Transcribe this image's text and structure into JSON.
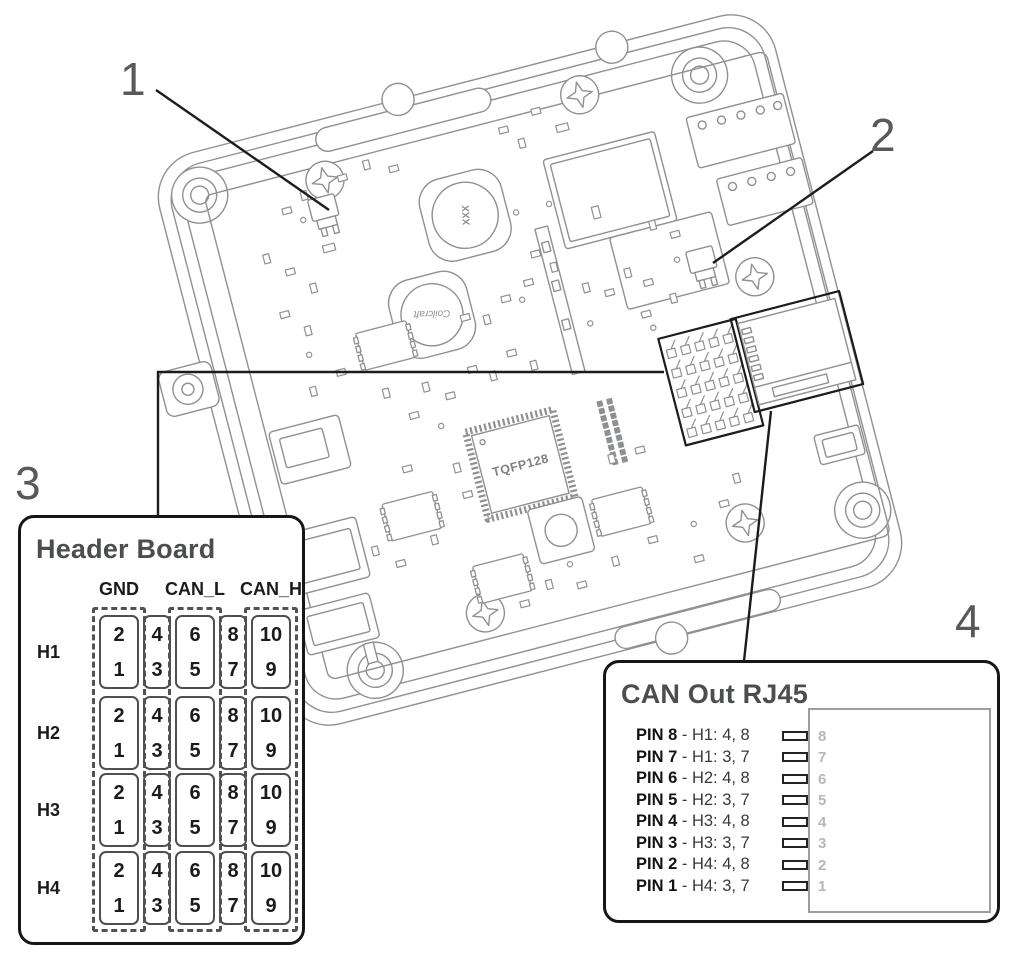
{
  "figure": {
    "callouts": {
      "c1": "1",
      "c2": "2",
      "c3": "3",
      "c4": "4"
    }
  },
  "board": {
    "chip_label": "TQFP128",
    "inductor_top_label": "XXX",
    "inductor_bottom_label": "Coilcraft"
  },
  "header_board": {
    "title": "Header Board",
    "columns": [
      "GND",
      "CAN_L",
      "CAN_H"
    ],
    "rows": [
      "H1",
      "H2",
      "H3",
      "H4"
    ],
    "cell_pairs": [
      [
        "2",
        "1"
      ],
      [
        "4",
        "3"
      ],
      [
        "6",
        "5"
      ],
      [
        "8",
        "7"
      ],
      [
        "10",
        "9"
      ]
    ]
  },
  "can_out": {
    "title": "CAN Out RJ45",
    "pins": [
      {
        "label": "PIN 8",
        "map": "- H1: 4, 8",
        "num": "8"
      },
      {
        "label": "PIN 7",
        "map": "- H1: 3, 7",
        "num": "7"
      },
      {
        "label": "PIN 6",
        "map": "- H2: 4, 8",
        "num": "6"
      },
      {
        "label": "PIN 5",
        "map": "- H2: 3, 7",
        "num": "5"
      },
      {
        "label": "PIN 4",
        "map": "- H3: 4, 8",
        "num": "4"
      },
      {
        "label": "PIN 3",
        "map": "- H3: 3, 7",
        "num": "3"
      },
      {
        "label": "PIN 2",
        "map": "- H4: 4, 8",
        "num": "2"
      },
      {
        "label": "PIN 1",
        "map": "- H4: 3, 7",
        "num": "1"
      }
    ]
  },
  "colors": {
    "leader_black": "#1c1c1c",
    "title_gray": "#4c4d4f",
    "callout_gray": "#58595c",
    "faded_pin_gray": "#b5b7b9",
    "line_art_gray": "#8f9092"
  }
}
